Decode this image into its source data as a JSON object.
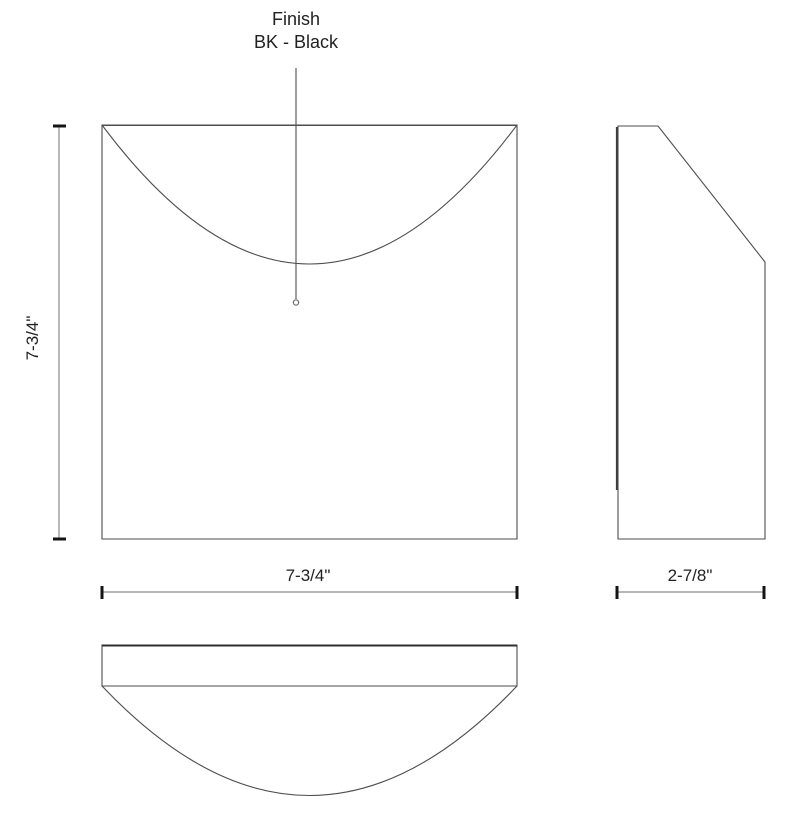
{
  "annotation": {
    "line1": "Finish",
    "line2": "BK - Black"
  },
  "dimensions": {
    "front_height": "7-3/4\"",
    "front_width": "7-3/4\"",
    "side_depth": "2-7/8\""
  },
  "colors": {
    "background": "#ffffff",
    "outline": "#4d4d4d",
    "dimension_line": "#8a8a8a",
    "tick": "#141414",
    "text": "#222222"
  }
}
